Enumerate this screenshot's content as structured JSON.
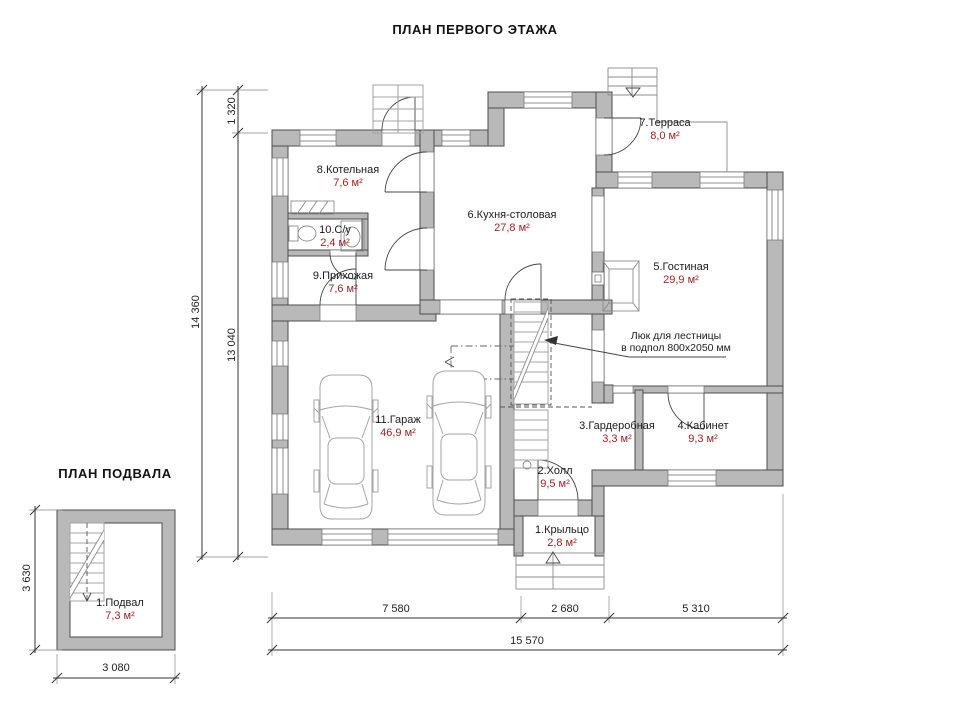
{
  "first_floor": {
    "title": "ПЛАН ПЕРВОГО ЭТАЖА",
    "rooms": [
      {
        "name": "1.Крыльцо",
        "area": "2,8 м²"
      },
      {
        "name": "2.Холл",
        "area": "9,5 м²"
      },
      {
        "name": "3.Гардеробная",
        "area": "3,3 м²"
      },
      {
        "name": "4.Кабинет",
        "area": "9,3 м²"
      },
      {
        "name": "5.Гостиная",
        "area": "29,9 м²"
      },
      {
        "name": "6.Кухня-столовая",
        "area": "27,8 м²"
      },
      {
        "name": "7.Терраса",
        "area": "8,0 м²"
      },
      {
        "name": "8.Котельная",
        "area": "7,6 м²"
      },
      {
        "name": "9.Прихожая",
        "area": "7,6 м²"
      },
      {
        "name": "10.С/у",
        "area": "2,4 м²"
      },
      {
        "name": "11.Гараж",
        "area": "46,9 м²"
      }
    ],
    "annotation": {
      "line1": "Люк для лестницы",
      "line2": "в подпол 800х2050 мм"
    },
    "dimensions": {
      "height_total": "14 360",
      "height_top": "1 320",
      "height_main": "13 040",
      "width_segments": [
        "7 580",
        "2 680",
        "5 310"
      ],
      "width_total": "15 570"
    }
  },
  "basement": {
    "title": "ПЛАН ПОДВАЛА",
    "room": {
      "name": "1.Подвал",
      "area": "7,3 м²"
    },
    "dimensions": {
      "height": "3 630",
      "width": "3 080"
    }
  },
  "colors": {
    "wall_fill": "#b9b9b9",
    "wall_outline": "#4d4d4d",
    "room_name_text": "#1b1b1b",
    "room_area_text": "#9c1f1f",
    "background": "#ffffff"
  }
}
